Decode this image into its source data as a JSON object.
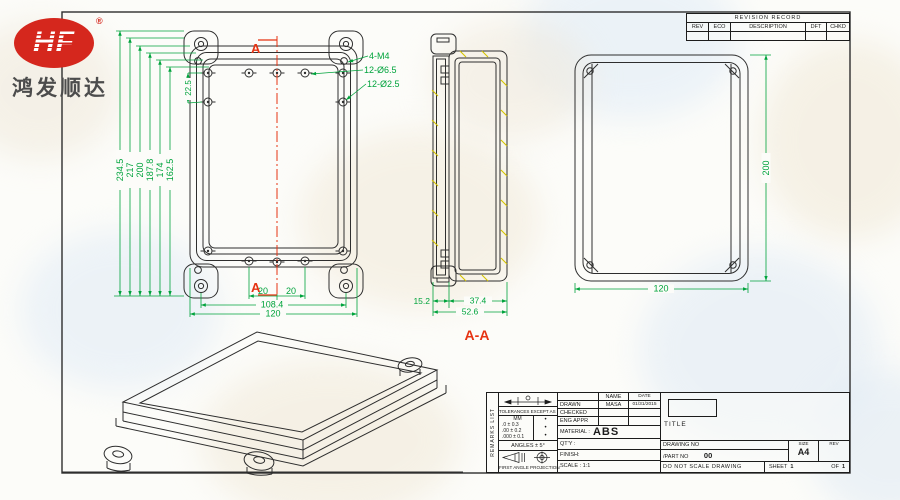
{
  "logo": {
    "brand": "HF",
    "registered": "®",
    "company": "鸿发顺达"
  },
  "revision_table": {
    "title": "REVISION RECORD",
    "columns": [
      "REV",
      "ECO",
      "DESCRIPTION",
      "DFT",
      "CHKD"
    ]
  },
  "front_view": {
    "section_letter_top": "A",
    "section_letter_bottom": "A",
    "dims_vertical": [
      "234.5",
      "217",
      "200",
      "187.8",
      "174",
      "162.5"
    ],
    "dim_lug_offset": "22.5",
    "dim_hole_left": "20",
    "dim_hole_right": "20",
    "dim_mount_span": "108.4",
    "dim_width": "120",
    "callouts": [
      "4-M4",
      "12-Ø6.5",
      "12-Ø2.5"
    ]
  },
  "section_view": {
    "label": "A-A",
    "dim_lid": "15.2",
    "dim_base": "37.4",
    "dim_total": "52.6"
  },
  "back_view": {
    "dim_height": "200",
    "dim_width": "120"
  },
  "title_block": {
    "remarks": "REMARKS LIST",
    "tolerances_title": "TOLERANCES EXCEPT AS NOTED",
    "unit": "MM",
    "tolerances": [
      ".0 ± 0.3",
      ".00 ± 0.2",
      ".000 ± 0.1"
    ],
    "bullet": "•",
    "angles": "ANGLES ± 5°",
    "projection_label": "FIRST ANGLE PROJECTION",
    "name_header": "NAME",
    "date_header": "DATE",
    "drawn_label": "DRAWN",
    "drawn_name": "MASA",
    "drawn_date": "01/31/2015",
    "checked_label": "CHECKED",
    "eng_appr_label": "ENG APPR",
    "material_label": "MATERIAL :",
    "material_value": "ABS",
    "qty_label": "QT'Y :",
    "finish_label": "FINISH:",
    "scale_label": "SCALE : 1:1",
    "title_label": "TITLE",
    "drawing_no_label": "DRAWING NO",
    "part_no_label": "/PART NO",
    "part_no_value": "00",
    "size_label": "SIZE",
    "size_value": "A4",
    "rev_label": "REV",
    "no_scale_note": "DO NOT SCALE DRAWING",
    "sheet_label": "SHEET",
    "sheet_no": "1",
    "of_label": "OF",
    "sheet_total": "1"
  },
  "colors": {
    "dimension_green": "#00a33c",
    "section_red": "#e63312",
    "logo_red": "#d5271d",
    "hatch_yellow": "#d4c400",
    "line": "#2e2e2e"
  }
}
